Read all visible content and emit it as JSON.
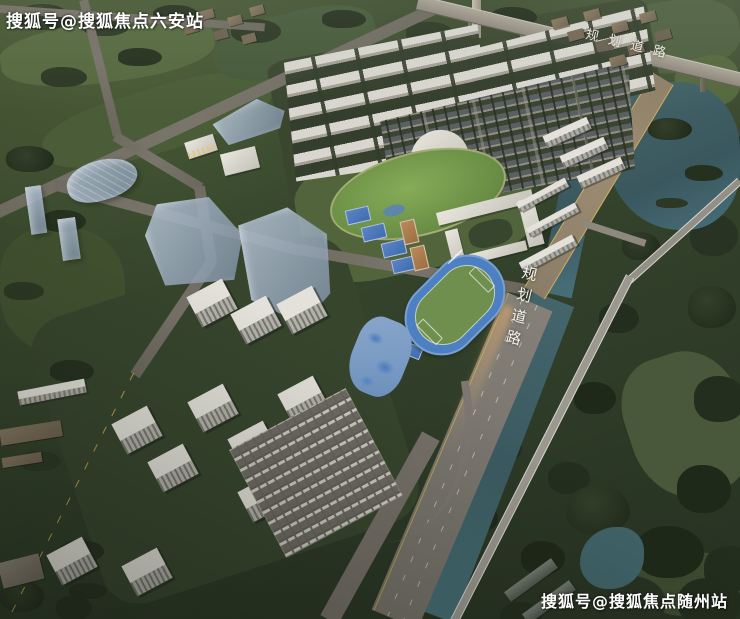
{
  "watermarks": {
    "top_left": "搜狐号@搜狐焦点六安站",
    "bottom_right": "搜狐号@搜狐焦点随州站"
  },
  "road_labels": {
    "viaduct_road": "规划道路",
    "main_road": "规划道路"
  },
  "palette": {
    "tree_dark": "#26301f",
    "field_green": "#4e6039",
    "lawn_green": "#7da353",
    "river_teal": "#44666a",
    "road_gray": "#74705f",
    "road_warm": "#9c8c72",
    "track_blue": "#4c80c2",
    "pitch_green": "#6f8f4f",
    "building_white": "#d8d6cf",
    "glass_blue": "#a8b6c6",
    "streetlight_warm": "#ffd9a0",
    "watermark_white": "#ffffff"
  }
}
